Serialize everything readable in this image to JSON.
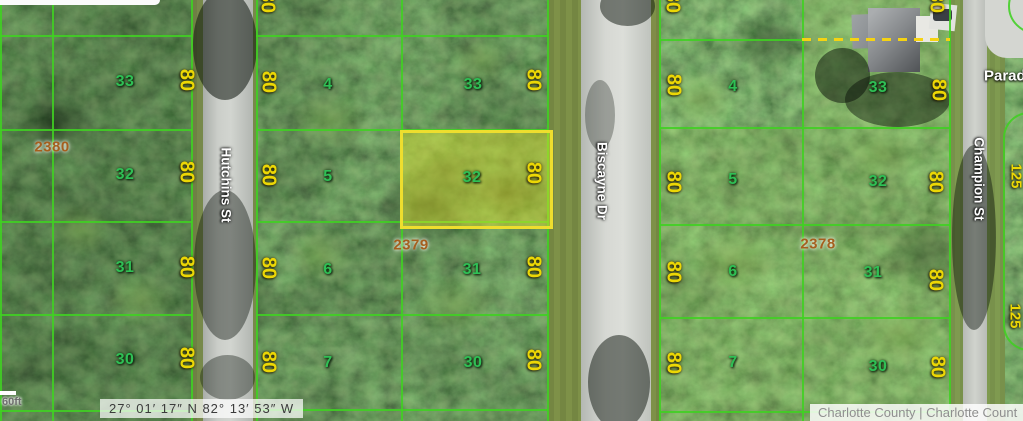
{
  "map": {
    "type": "satellite-parcel-map",
    "scale_label": "60ft",
    "coordinates": "27° 01′ 17″ N 82° 13′ 53″ W",
    "attribution": "Charlotte County | Charlotte Count",
    "streets": {
      "west": "Hutchins St",
      "center": "Biscayne Dr",
      "east": "Champion St",
      "northeast_partial": "Paradi"
    },
    "dimensions": {
      "lot_frontage": "80",
      "side": "125"
    },
    "blocks": [
      {
        "number": "2380",
        "lots": [
          "33",
          "32",
          "31",
          "30"
        ]
      },
      {
        "number": "2379",
        "lots_west": [
          "4",
          "5",
          "6",
          "7"
        ],
        "lots_east": [
          "33",
          "32",
          "31",
          "30"
        ],
        "highlighted_lot": "32"
      },
      {
        "number": "2378",
        "lots_west": [
          "4",
          "5",
          "6",
          "7"
        ],
        "lots_east": [
          "33",
          "32",
          "31",
          "30"
        ]
      }
    ],
    "colors": {
      "parcel_line": "#40d022",
      "highlight_border": "#eede2e",
      "highlight_fill": "#dee230",
      "lot_number": "#2fbf55",
      "dimension_label": "#ecd705",
      "block_number": "#a55f1e",
      "boundary_dash": "#f5d312",
      "street_label": "#ffffff"
    }
  }
}
